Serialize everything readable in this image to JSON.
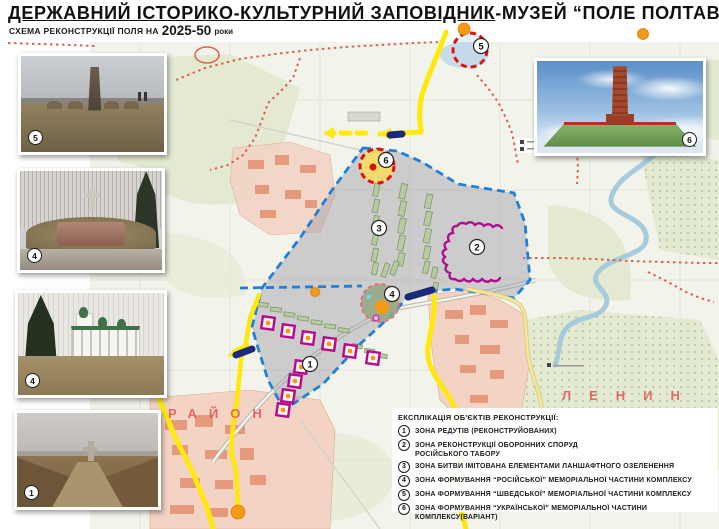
{
  "header": {
    "title_main": "ДЕРЖАВНИЙ ІСТОРИКО-КУЛЬТУРНИЙ ЗАПОВІДНИК",
    "title_rest": "-МУЗЕЙ “ПОЛЕ ПОЛТАВСЬКОЇ БИТВИ”",
    "subtitle_label": "СХЕМА РЕКОНСТРУКЦІЇ ПОЛЯ НА",
    "subtitle_years": "2025-50",
    "subtitle_units": "роки"
  },
  "photos": {
    "swedish_monument_badge": "5",
    "cross_monument_badge": "4",
    "church_badge": "4",
    "redoubt_badge": "1",
    "obelisk_render_badge": "6"
  },
  "map": {
    "zone_numbers": [
      "1",
      "2",
      "3",
      "4",
      "5",
      "6"
    ],
    "district_labels": [
      "РАЙОН",
      "ЛЕНИН"
    ]
  },
  "legend": {
    "title": "ЕКСПЛІКАЦІЯ ОБ'ЄКТІВ РЕКОНСТРУКЦІЇ:",
    "items": [
      {
        "num": "1",
        "text": "ЗОНА РЕДУТІВ (РЕКОНСТРУЙОВАНИХ)"
      },
      {
        "num": "2",
        "text": "ЗОНА РЕКОНСТРУКЦІЇ ОБОРОННИХ СПОРУД\nРОСІЙСЬКОГО ТАБОРУ"
      },
      {
        "num": "3",
        "text": "ЗОНА БИТВИ ІМІТОВАНА ЕЛЕМЕНТАМИ ЛАНШАФТНОГО ОЗЕЛЕНЕННЯ"
      },
      {
        "num": "4",
        "text": "ЗОНА ФОРМУВАННЯ “РОСІЙСЬКОЇ” МЕМОРІАЛЬНОЇ ЧАСТИНИ КОМПЛЕКСУ"
      },
      {
        "num": "5",
        "text": "ЗОНА ФОРМУВАННЯ “ШВЕДСЬКОЇ” МЕМОРІАЛЬНОЇ ЧАСТИНИ КОМПЛЕКСУ"
      },
      {
        "num": "6",
        "text": "ЗОНА ФОРМУВАННЯ “УКРАЇНСЬКОЇ” МЕМОРІАЛЬНОЇ ЧАСТИНИ КОМПЛЕКСУ(ВАРІАНТ)"
      }
    ]
  },
  "colors": {
    "boundary_blue": "#1f80d8",
    "zone_dash_red": "#e01010",
    "redoubt_magenta": "#b80890",
    "road_yellow": "#ffe80a",
    "marker_orange": "#f59a14",
    "district_red": "#e05454"
  }
}
